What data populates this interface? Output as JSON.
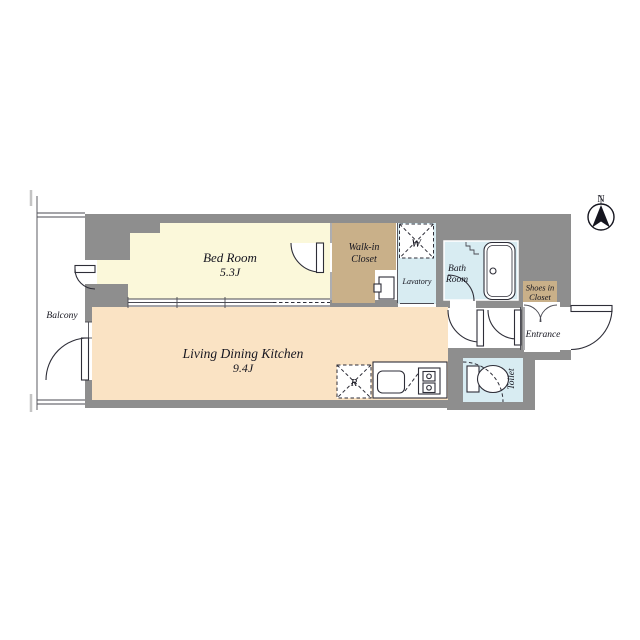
{
  "plan": {
    "type": "apartment-floor-plan",
    "rooms": {
      "bedroom": {
        "label": "Bed Room",
        "area": "5.3J"
      },
      "ldk": {
        "label": "Living Dining Kitchen",
        "area": "9.4J"
      },
      "walk_in_closet": {
        "line1": "Walk-in",
        "line2": "Closet"
      },
      "lavatory": {
        "label": "Lavatory"
      },
      "bath": {
        "line1": "Bath",
        "line2": "Room"
      },
      "shoes_closet": {
        "line1": "Shoes in",
        "line2": "Closet"
      },
      "entrance": {
        "label": "Entrance"
      },
      "toilet": {
        "label": "Toilet"
      },
      "balcony": {
        "label": "Balcony"
      }
    },
    "appliances": {
      "washer": "W",
      "refrigerator": "R"
    },
    "compass": {
      "north": "N"
    },
    "colors": {
      "wall": "#8e8e8e",
      "bedroom_fill": "#fbf8da",
      "ldk_fill": "#fae3c4",
      "closet_fill": "#c9b089",
      "wet_area_fill": "#d8ecf2",
      "line": "#2e2e38",
      "text": "#15151f"
    }
  }
}
